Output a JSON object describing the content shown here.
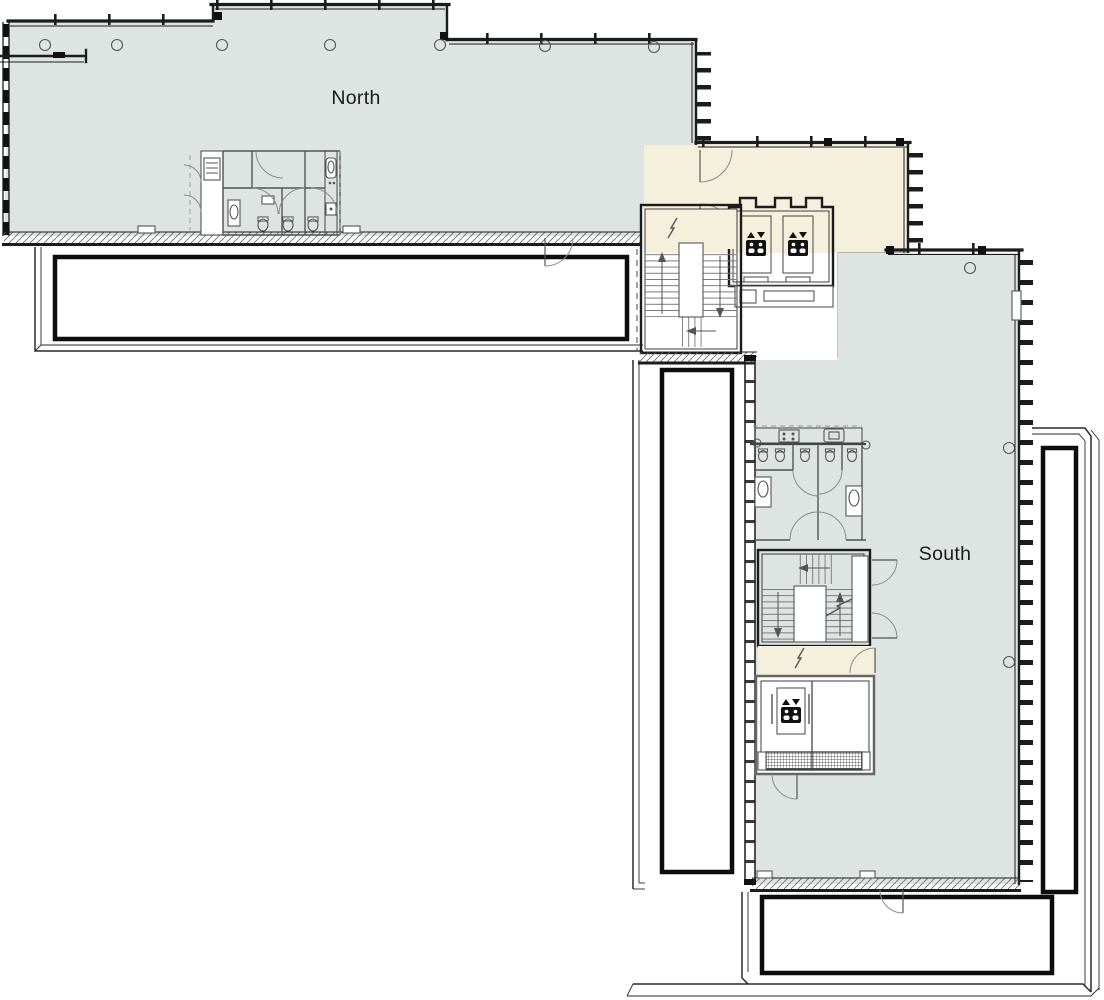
{
  "page": {
    "type": "architectural floor plan",
    "wings": [
      "North",
      "South"
    ]
  },
  "labels": {
    "north_wing": "North",
    "south_wing": "South"
  },
  "colors": {
    "background": "#ffffff",
    "wing_fill": "#dde4e1",
    "lobby_fill": "#f5f0dc",
    "wall_dark": "#1c1c1c",
    "line_medium": "#555555",
    "parapet_black": "#0d0d0d"
  },
  "icons": {
    "elevator": "elevator-cab-pictogram-with-up-down-arrows"
  },
  "features": {
    "central_elevators": 2,
    "south_elevators": 1,
    "stairwells": 2,
    "restroom_blocks": 2,
    "terraces": 4
  }
}
